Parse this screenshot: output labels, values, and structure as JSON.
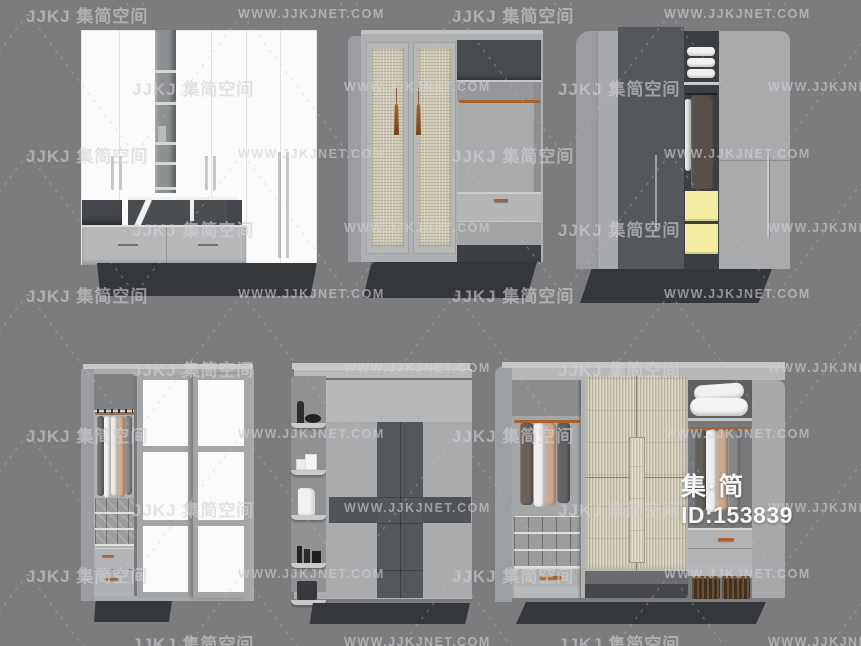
{
  "background": "#7c7c7e",
  "watermark": {
    "brand_text": "JJKJ 集简空间",
    "site_text": "WWW.JJKJNET.COM",
    "text_color": "rgba(210,210,213,0.6)",
    "rows_y": [
      8,
      81,
      148,
      222,
      288,
      362,
      428,
      502,
      568,
      636
    ],
    "columns_even": [
      {
        "type": "brand",
        "x": 26
      },
      {
        "type": "site",
        "x": 238
      },
      {
        "type": "brand",
        "x": 452
      },
      {
        "type": "site",
        "x": 664
      }
    ],
    "columns_odd": [
      {
        "type": "brand",
        "x": 132
      },
      {
        "type": "site",
        "x": 344
      },
      {
        "type": "brand",
        "x": 558
      },
      {
        "type": "site",
        "x": 768
      }
    ]
  },
  "overlay": {
    "brand_text": "集·简",
    "id_text": "ID:153839"
  },
  "colors": {
    "bg": "#7c7c7e",
    "wood": "#a9abad",
    "wood-light": "#b6b8ba",
    "wood-dark": "#9b9da0",
    "white-panel": "#fbfbfb",
    "dark-panel": "#55585b",
    "cavity": "#3c3f42",
    "plinth": "#35383b",
    "rattan": "#cdc7b4",
    "rattan-light": "#d8d2bf",
    "copper": "#a9622e",
    "yellow": "#f4eda4",
    "towel": "#f2f2f2",
    "tan": "#d0ab90",
    "charcoal": "#6b6d70",
    "basket": "#42311f"
  }
}
